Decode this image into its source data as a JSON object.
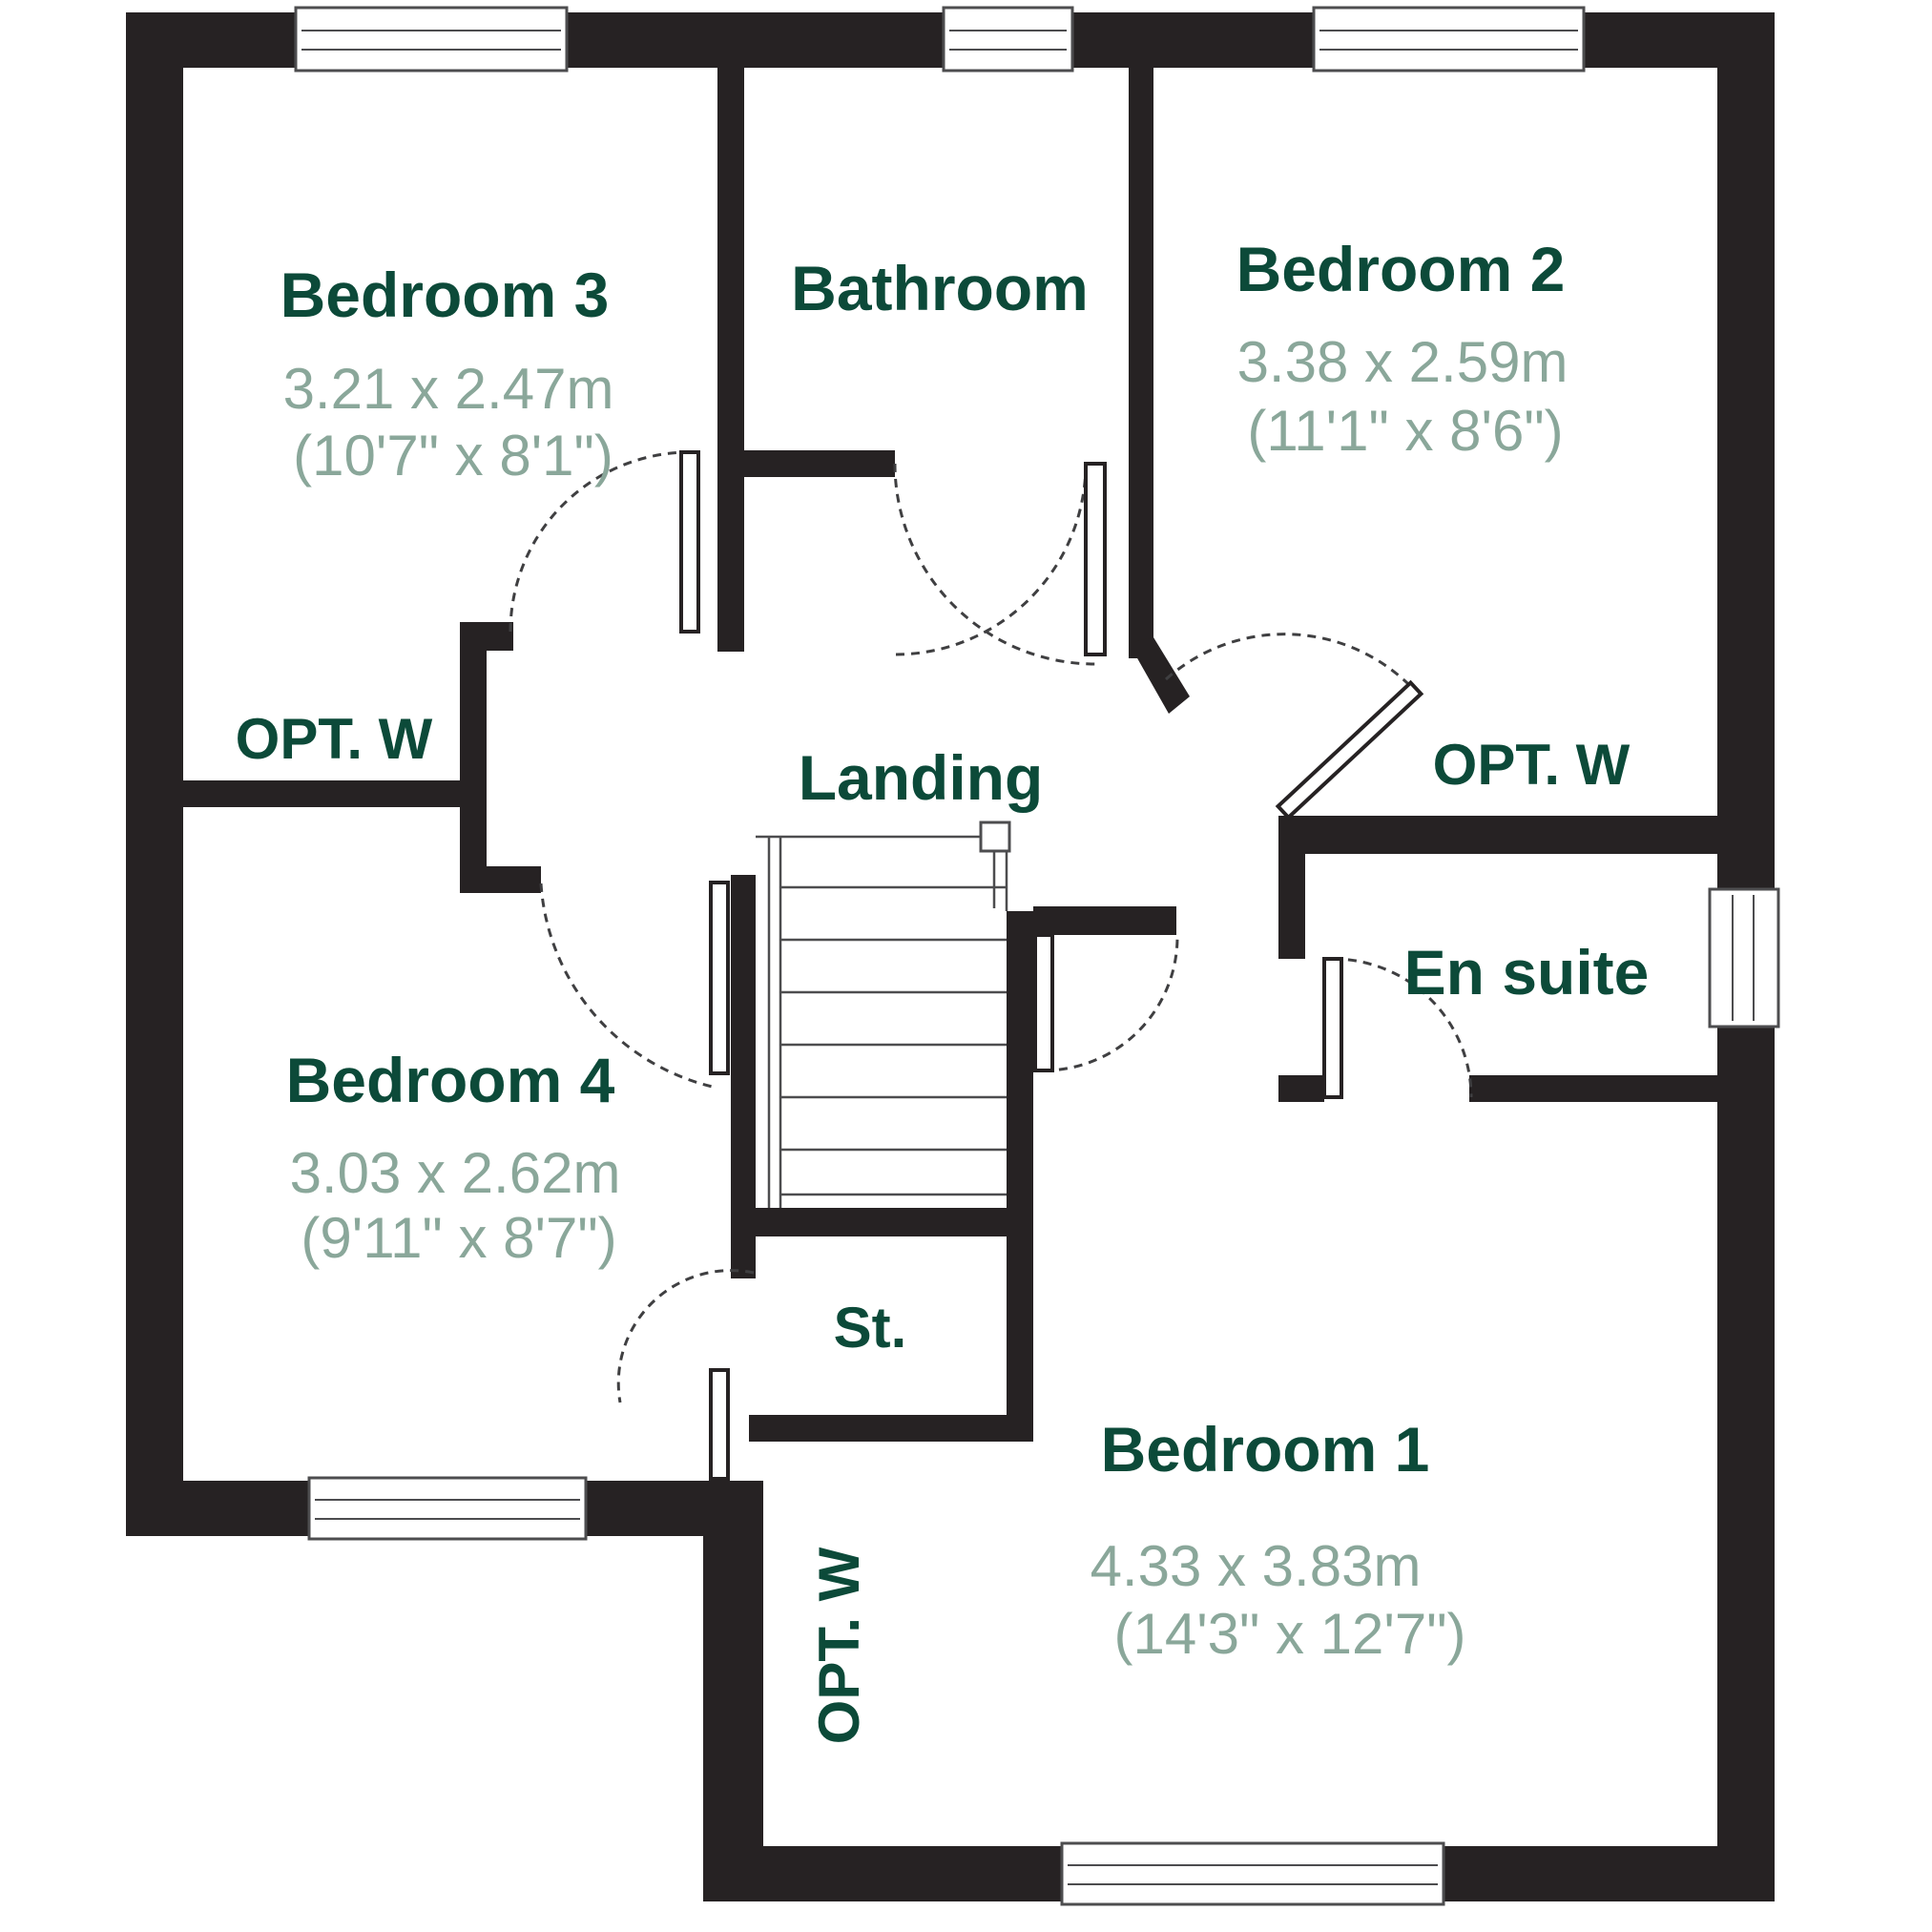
{
  "plan": {
    "rooms": {
      "bedroom3": {
        "name": "Bedroom 3",
        "metric": "3.21 x 2.47m",
        "imperial": "(10'7\" x 8'1\")"
      },
      "bathroom": {
        "name": "Bathroom"
      },
      "bedroom2": {
        "name": "Bedroom 2",
        "metric": "3.38 x 2.59m",
        "imperial": "(11'1\" x 8'6\")"
      },
      "landing": {
        "name": "Landing"
      },
      "bedroom4": {
        "name": "Bedroom 4",
        "metric": "3.03 x 2.62m",
        "imperial": "(9'11\" x 8'7\")"
      },
      "ensuite": {
        "name": "En suite"
      },
      "store": {
        "name": "St."
      },
      "bedroom1": {
        "name": "Bedroom 1",
        "metric": "4.33 x 3.83m",
        "imperial": "(14'3\" x 12'7\")"
      }
    },
    "annotations": {
      "opt_w_left": "OPT. W",
      "opt_w_right": "OPT. W",
      "opt_w_bottom": "OPT. W"
    },
    "colors": {
      "wall": "#262223",
      "room_name": "#0c4a39",
      "dimensions": "#8aa79a",
      "line": "#4d4d4f"
    }
  }
}
